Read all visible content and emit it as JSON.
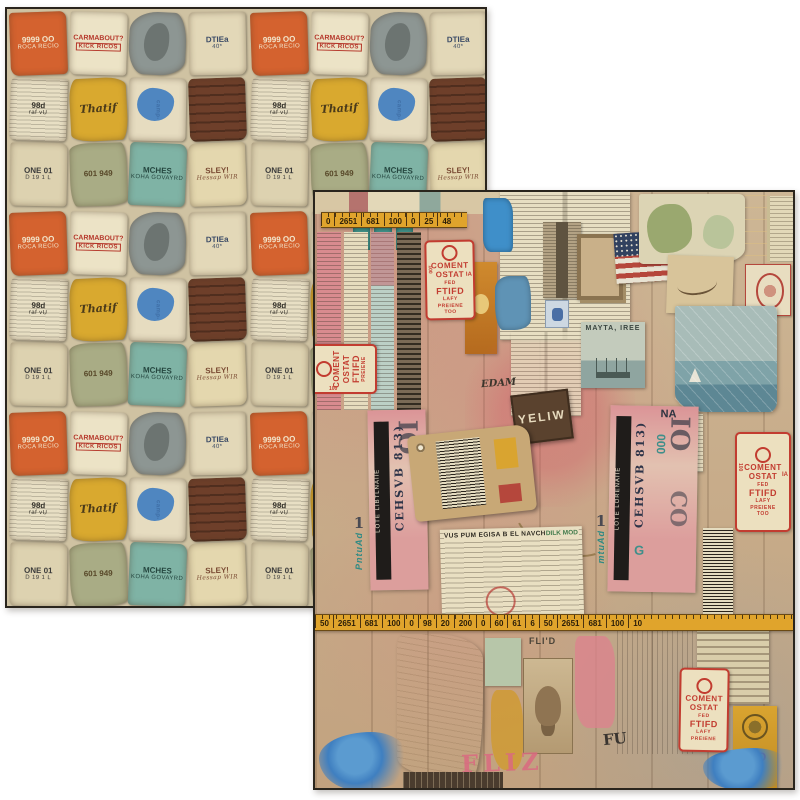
{
  "product": {
    "description": "Two overlapping sheets of double-sided vintage ephemera collage scrapbook paper on a white background; back sheet shows small repeating torn-label pattern, front sheet shows large collage of tickets, stamps, maps, photos and measuring tapes"
  },
  "colors": {
    "background": "#ffffff",
    "sheet_border": "#2a251d",
    "tape_yellow": "#e0a42c",
    "stamp_red": "#c23c30",
    "ticket_pink": "#d98f9a",
    "paint_blue": "#3f7fc0",
    "kraft": "#c8a876",
    "newsprint": "#e7dec2"
  },
  "back_sheet": {
    "name": "reverse-side-pattern",
    "scraps": [
      {
        "t": "9999 OO",
        "u": "ROCA RECIO",
        "bg": "#d4622f",
        "fg": "#f2e6cc"
      },
      {
        "t": "CARMABOUT?",
        "u": "KICK RICOS",
        "bg": "#ece3c6",
        "fg": "#b5372a"
      },
      {
        "t": "",
        "u": "",
        "bg": "#8d9693",
        "fg": "#555555"
      },
      {
        "t": "DTIEa",
        "u": "40*",
        "bg": "#e3d8b8",
        "fg": "#3a4a66"
      },
      {
        "t": "98d",
        "u": "raf vU",
        "bg": "#e8dfc4",
        "fg": "#35322b"
      },
      {
        "t": "Thatif",
        "u": "",
        "bg": "#d9a92f",
        "fg": "#4a3a1a"
      },
      {
        "t": "",
        "u": "camp-",
        "bg": "#e6dcc0",
        "fg": "#3f6ea5"
      },
      {
        "t": "",
        "u": "",
        "bg": "#6e3f2a",
        "fg": "#d8c9a8"
      },
      {
        "t": "ONE 01",
        "u": "D 19 1 L",
        "bg": "#ddd2b0",
        "fg": "#3a3a3a"
      },
      {
        "t": "601 949",
        "u": "",
        "bg": "#a9ac85",
        "fg": "#574728"
      },
      {
        "t": "MCHES",
        "u": "KOHA GOVAYRD",
        "bg": "#7fb3a5",
        "fg": "#24453e"
      },
      {
        "t": "SLEY!",
        "u": "Hessap WIR",
        "bg": "#e4d7ae",
        "fg": "#7a4a33"
      }
    ]
  },
  "front_sheet": {
    "name": "front-side-collage",
    "tape_top": {
      "marks": [
        "0",
        "2651",
        "681",
        "100",
        "0",
        "25",
        "48"
      ]
    },
    "tape_bottom": {
      "marks": [
        "50",
        "2651",
        "681",
        "100",
        "0",
        "98",
        "20",
        "200",
        "0",
        "60",
        "61",
        "6",
        "50",
        "2651",
        "681",
        "100",
        "10"
      ]
    },
    "stamp": {
      "line1": "COMENT",
      "line2": "OSTAT",
      "line3": "FED",
      "line4": "FTIFD",
      "line5": "LAFY",
      "line6": "PREIENE",
      "line7": "TOO",
      "side": "100",
      "ia": "IA"
    },
    "mayta_card": {
      "caption": "MAYTA, IREE"
    },
    "ticket_left": {
      "band": "LOTE LIBTLNAIIE",
      "serial": "CEHSVB 813)",
      "big": "IO",
      "side": "PntuAd",
      "num": "1"
    },
    "ticket_right": {
      "band": "LOTE LORENAIIE",
      "serial": "CEHSVB 813)",
      "big": "IO",
      "big2": "CO",
      "side": "mtuAd",
      "num": "1",
      "na": "NA",
      "teal": "000",
      "g": "G"
    },
    "receipt": {
      "header": "VUS PUM EGISA B EL NAVCHE",
      "side": "DILK MOD"
    },
    "dark_ticket": {
      "text": "YELIW"
    },
    "edam": {
      "text": "EDAM"
    },
    "portrait_label": {
      "text": "FLI'D"
    },
    "paint": {
      "pink": "FLIZ",
      "dark": "FU"
    },
    "yellow_label": {
      "text": "CIO"
    }
  }
}
